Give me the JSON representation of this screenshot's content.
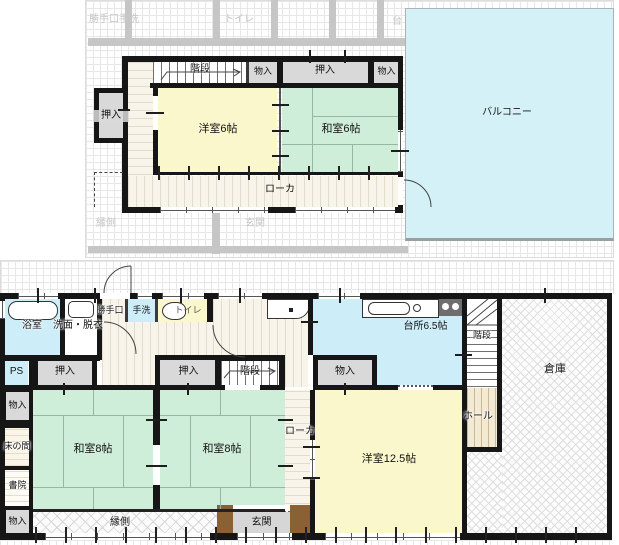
{
  "floor2": {
    "balcony": "バルコニー",
    "stairs": "階段",
    "storage_a": "物入",
    "closet_top": "押入",
    "storage_b": "物入",
    "closet_left": "押入",
    "western_room": "洋室6帖",
    "japanese_room": "和室6帖",
    "corridor": "ローカ",
    "ghost": {
      "back_door_wash": "勝手口手洗",
      "toilet": "トイレ",
      "kitchen_partial": "台",
      "veranda": "縁側",
      "entrance": "玄関"
    }
  },
  "floor1": {
    "bath": "浴室",
    "washroom": "洗面・脱衣",
    "back_door": "勝手口",
    "hand_wash": "手洗",
    "toilet": "トイレ",
    "kitchen": "台所6.5帖",
    "stairs_straight": "階段",
    "stairs_winder": "階段",
    "warehouse": "倉庫",
    "hall": "ホール",
    "pipe_space": "PS",
    "closet_a": "押入",
    "closet_b": "押入",
    "storage_kitchen": "物入",
    "storage_a": "物入",
    "tokonoma": "床の間",
    "shoin": "書院",
    "storage_b": "物入",
    "japanese_room_left": "和室8帖",
    "japanese_room_right": "和室8帖",
    "corridor": "ローカ",
    "western_room": "洋室12.5帖",
    "veranda": "縁側",
    "entrance": "玄関"
  },
  "colors": {
    "wall": "#161616",
    "western_room": "#fbf7cd",
    "japanese_room": "#cfeeda",
    "water_blue": "#cdedf8",
    "closet_gray": "#d9d9d9",
    "corridor_cream": "#f8f4ea",
    "wood_brown": "#8a6134",
    "ghost_gray": "#c6c6c6"
  }
}
